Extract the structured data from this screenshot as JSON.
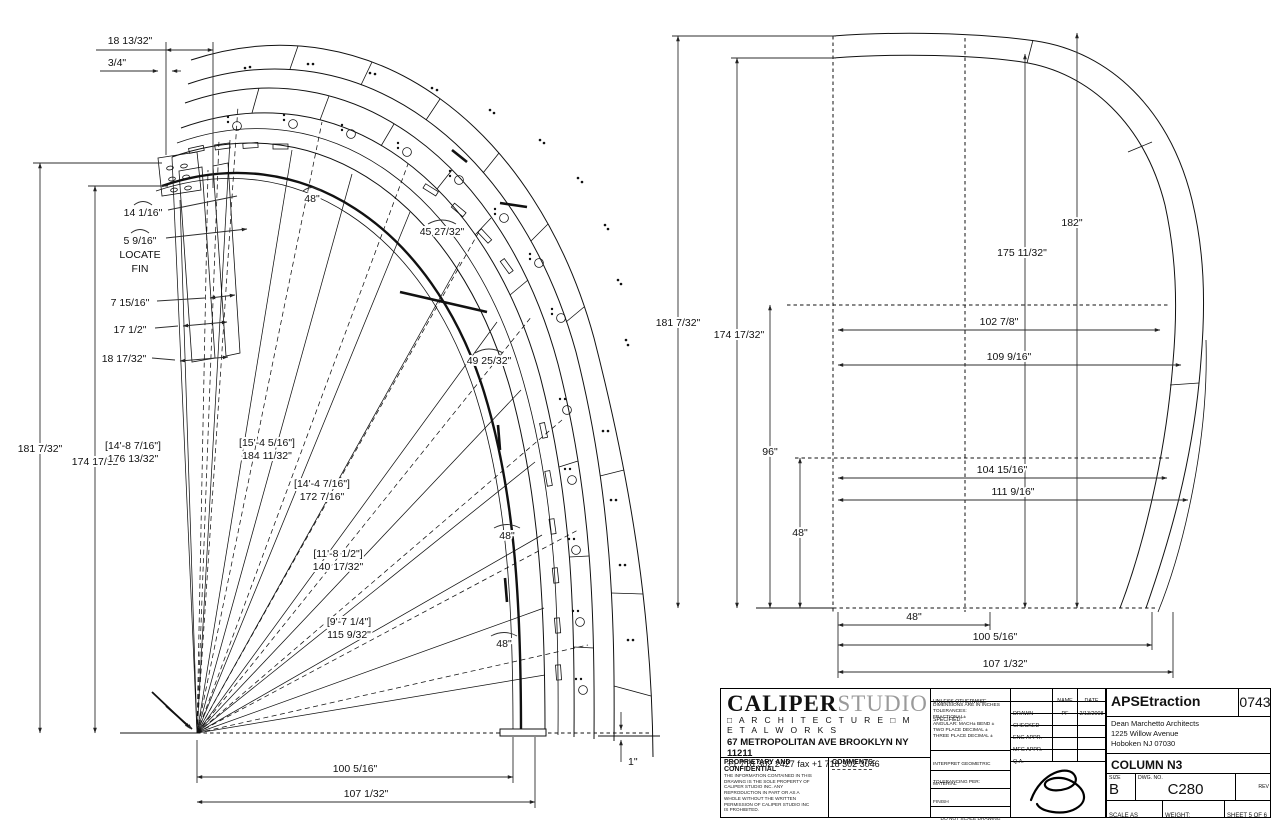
{
  "left_view": {
    "dim_18_13_32": "18 13/32\"",
    "dim_3_4": "3/4\"",
    "dim_14_1_16": "14 1/16\"",
    "dim_5_9_16": "5 9/16\"",
    "locate_line1": "LOCATE",
    "locate_line2": "FIN",
    "dim_7_15_16": "7 15/16\"",
    "dim_17_1_2": "17 1/2\"",
    "dim_18_17_32": "18 17/32\"",
    "dim_181_7_32": "181 7/32\"",
    "dim_174_17_32": "174 17/32\"",
    "radial_labels": [
      {
        "bracket": "[14'-8 7/16\"]",
        "value": "176 13/32\""
      },
      {
        "bracket": "[15'-4 5/16\"]",
        "value": "184 11/32\""
      },
      {
        "bracket": "[14'-4 7/16\"]",
        "value": "172 7/16\""
      },
      {
        "bracket": "[11'-8 1/2\"]",
        "value": "140 17/32\""
      },
      {
        "bracket": "[9'-7 1/4\"]",
        "value": "115 9/32\""
      }
    ],
    "arc_labels": [
      "48\"",
      "45 27/32\"",
      "49 25/32\"",
      "48\"",
      "48\""
    ],
    "dim_100_5_16": "100 5/16\"",
    "dim_107_1_32": "107 1/32\"",
    "dim_1": "1\""
  },
  "right_view": {
    "dim_181_7_32": "181 7/32\"",
    "dim_174_17_32": "174 17/32\"",
    "dim_96": "96\"",
    "dim_48_v": "48\"",
    "dim_182": "182\"",
    "dim_175_11_32": "175 11/32\"",
    "dim_102_7_8": "102 7/8\"",
    "dim_109_9_16": "109 9/16\"",
    "dim_104_15_16": "104 15/16\"",
    "dim_111_9_16": "111 9/16\"",
    "dim_48_h": "48\"",
    "dim_100_5_16": "100 5/16\"",
    "dim_107_1_32": "107 1/32\""
  },
  "title_block": {
    "logo_primary": "CALIPER",
    "logo_secondary": "STUDIO",
    "logo_sub": "□ A R C H I T E C T U R E   □ M E T A L W O R K S",
    "address": "67 METROPOLITAN AVE  BROOKLYN  NY  11211",
    "phone": "+1 718 302 2427     fax  +1 718 302 3046",
    "proprietary_title": "PROPRIETARY AND CONFIDENTIAL",
    "proprietary_body": "THE INFORMATION CONTAINED IN THIS DRAWING IS THE SOLE PROPERTY OF CALIPER STUDIO INC.  ANY REPRODUCTION IN PART OR AS A WHOLE WITHOUT THE WRITTEN PERMISSION OF CALIPER STUDIO INC IS PROHIBITED.",
    "comments_label": "COMMENTS:",
    "spec_header": "UNLESS OTHERWISE SPECIFIED:",
    "spec_lines": [
      "DIMENSIONS ARE IN INCHES",
      "TOLERANCES:",
      "FRACTIONAL±",
      "ANGULAR: MACH±   BEND ±",
      "TWO PLACE DECIMAL    ±",
      "THREE PLACE DECIMAL  ±"
    ],
    "interpret": "INTERPRET GEOMETRIC TOLERANCING PER:",
    "material_label": "MATERIAL",
    "finish_label": "FINISH",
    "do_not_scale": "DO NOT SCALE DRAWING",
    "col_name": "NAME",
    "col_date": "DATE",
    "rows": [
      {
        "label": "DRAWN",
        "name": "PF",
        "date": "2/13/2008"
      },
      {
        "label": "CHECKED",
        "name": "",
        "date": ""
      },
      {
        "label": "ENG APPR.",
        "name": "",
        "date": ""
      },
      {
        "label": "MFG APPR.",
        "name": "",
        "date": ""
      },
      {
        "label": "Q.A.",
        "name": "",
        "date": ""
      }
    ],
    "project_title": "APSEtraction",
    "project_number": "0743",
    "client_lines": [
      "Dean Marchetto Architects",
      "1225 Willow Avenue",
      "Hoboken NJ 07030"
    ],
    "drawing_title": "COLUMN N3",
    "size_label": "SIZE",
    "size_value": "B",
    "dwg_label": "DWG.  NO.",
    "dwg_value": "C280",
    "rev_label": "REV",
    "scale_label": "SCALE AS NOTED",
    "weight_label": "WEIGHT:",
    "sheet_label": "SHEET 5 OF 6"
  }
}
